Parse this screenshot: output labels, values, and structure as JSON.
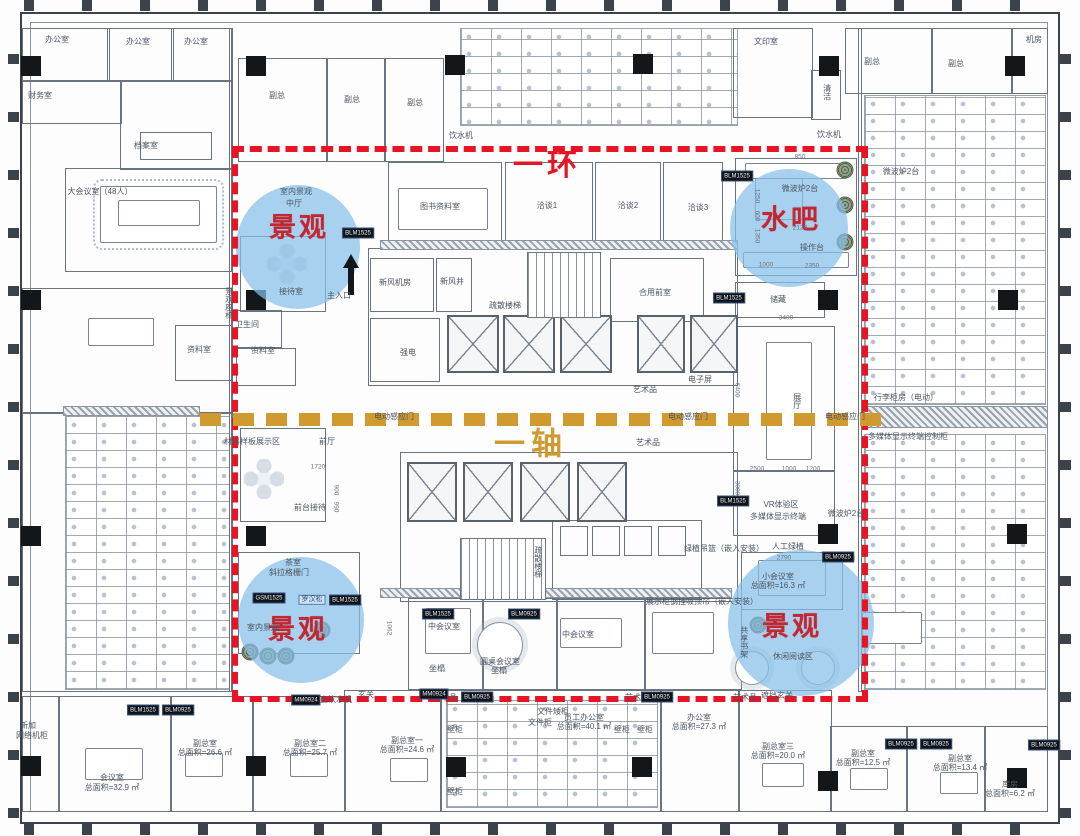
{
  "plan": {
    "ring_label": "一环",
    "axis_label": "一轴",
    "colors": {
      "ring_red": "#e81423",
      "axis_gold": "#d09a2e",
      "circle_blue": "#86bfe9",
      "annotation_red": "#c22832"
    }
  },
  "circles": [
    {
      "label": "景观",
      "cx": 298,
      "cy": 247,
      "r": 62,
      "lx": 299,
      "ly": 225
    },
    {
      "label": "水吧",
      "cx": 789,
      "cy": 228,
      "r": 59,
      "lx": 791,
      "ly": 217
    },
    {
      "label": "景观",
      "cx": 301,
      "cy": 620,
      "r": 63,
      "lx": 298,
      "ly": 627
    },
    {
      "label": "景观",
      "cx": 801,
      "cy": 623,
      "r": 73,
      "lx": 792,
      "ly": 624
    }
  ],
  "labels": [
    {
      "t": "办公室",
      "x": 57,
      "y": 40
    },
    {
      "t": "办公室",
      "x": 138,
      "y": 42
    },
    {
      "t": "办公室",
      "x": 196,
      "y": 42
    },
    {
      "t": "财务室",
      "x": 40,
      "y": 96
    },
    {
      "t": "档案室",
      "x": 146,
      "y": 146
    },
    {
      "t": "大会议室（48人）",
      "x": 100,
      "y": 192
    },
    {
      "t": "副总",
      "x": 277,
      "y": 96
    },
    {
      "t": "副总",
      "x": 352,
      "y": 100
    },
    {
      "t": "副总",
      "x": 415,
      "y": 103
    },
    {
      "t": "饮水机",
      "x": 461,
      "y": 136
    },
    {
      "t": "文印室",
      "x": 766,
      "y": 42
    },
    {
      "t": "清洁",
      "x": 827,
      "y": 92,
      "v": true
    },
    {
      "t": "副总",
      "x": 872,
      "y": 62
    },
    {
      "t": "副总",
      "x": 956,
      "y": 64
    },
    {
      "t": "机房",
      "x": 1034,
      "y": 40
    },
    {
      "t": "饮水机",
      "x": 829,
      "y": 135
    },
    {
      "t": "图书资料室",
      "x": 440,
      "y": 207
    },
    {
      "t": "洽谈1",
      "x": 547,
      "y": 206
    },
    {
      "t": "洽谈2",
      "x": 628,
      "y": 206
    },
    {
      "t": "洽谈3",
      "x": 698,
      "y": 208
    },
    {
      "t": "室内景观",
      "x": 296,
      "y": 192
    },
    {
      "t": "中厅",
      "x": 294,
      "y": 204
    },
    {
      "t": "景观座椅",
      "x": 229,
      "y": 303,
      "v": true
    },
    {
      "t": "接待室",
      "x": 291,
      "y": 292
    },
    {
      "t": "主入口",
      "x": 339,
      "y": 296
    },
    {
      "t": "卫生间",
      "x": 247,
      "y": 325
    },
    {
      "t": "资料室",
      "x": 199,
      "y": 350
    },
    {
      "t": "资料室",
      "x": 263,
      "y": 351
    },
    {
      "t": "新风机房",
      "x": 395,
      "y": 283
    },
    {
      "t": "新风井",
      "x": 452,
      "y": 282
    },
    {
      "t": "疏散楼梯",
      "x": 505,
      "y": 306
    },
    {
      "t": "合用前室",
      "x": 655,
      "y": 293
    },
    {
      "t": "强电",
      "x": 408,
      "y": 353
    },
    {
      "t": "艺术品",
      "x": 645,
      "y": 390
    },
    {
      "t": "电子屏",
      "x": 700,
      "y": 380
    },
    {
      "t": "艺术品",
      "x": 648,
      "y": 443
    },
    {
      "t": "微波炉2台",
      "x": 800,
      "y": 189
    },
    {
      "t": "微波炉2台",
      "x": 901,
      "y": 172
    },
    {
      "t": "操作台",
      "x": 812,
      "y": 248
    },
    {
      "t": "储藏",
      "x": 778,
      "y": 300
    },
    {
      "t": "材料样板展示区",
      "x": 252,
      "y": 442
    },
    {
      "t": "前厅",
      "x": 327,
      "y": 442
    },
    {
      "t": "前台接待",
      "x": 310,
      "y": 508
    },
    {
      "t": "电动感应门",
      "x": 394,
      "y": 417
    },
    {
      "t": "电动感应门",
      "x": 688,
      "y": 417
    },
    {
      "t": "电动感应门",
      "x": 845,
      "y": 417
    },
    {
      "t": "展厅",
      "x": 797,
      "y": 401,
      "v": true
    },
    {
      "t": "行李柜房（电动）",
      "x": 906,
      "y": 398
    },
    {
      "t": "多媒体显示终端控制柜",
      "x": 908,
      "y": 437
    },
    {
      "t": "VR体验区",
      "x": 781,
      "y": 505
    },
    {
      "t": "多媒体显示终端",
      "x": 778,
      "y": 517
    },
    {
      "t": "微波炉2台",
      "x": 846,
      "y": 514
    },
    {
      "t": "人工绿植",
      "x": 788,
      "y": 547
    },
    {
      "t": "绿植吊篮（嵌入安装）",
      "x": 724,
      "y": 549
    },
    {
      "t": "艺术品",
      "x": 843,
      "y": 557
    },
    {
      "t": "小会议室",
      "x": 778,
      "y": 577
    },
    {
      "t": "总面积=16.3 ㎡",
      "x": 778,
      "y": 586
    },
    {
      "t": "共享书架",
      "x": 744,
      "y": 642,
      "v": true
    },
    {
      "t": "休闲阅读区",
      "x": 793,
      "y": 657
    },
    {
      "t": "遮挡玄关",
      "x": 777,
      "y": 696
    },
    {
      "t": "茶室",
      "x": 293,
      "y": 563
    },
    {
      "t": "斜拉格栅门",
      "x": 289,
      "y": 573
    },
    {
      "t": "罗汉松",
      "x": 312,
      "y": 600,
      "c": "bluebox"
    },
    {
      "t": "室内景观",
      "x": 263,
      "y": 628
    },
    {
      "t": "中会议室",
      "x": 444,
      "y": 627
    },
    {
      "t": "圆桌会议室",
      "x": 500,
      "y": 662
    },
    {
      "t": "中会议室",
      "x": 578,
      "y": 635
    },
    {
      "t": "坐榻",
      "x": 437,
      "y": 669
    },
    {
      "t": "坐榻",
      "x": 499,
      "y": 671
    },
    {
      "t": "疏散楼梯",
      "x": 538,
      "y": 562,
      "v": true
    },
    {
      "t": "展示柜钢挂吸顶帘（嵌入安装）",
      "x": 702,
      "y": 602
    },
    {
      "t": "直饮水机",
      "x": 336,
      "y": 700
    },
    {
      "t": "玄关",
      "x": 366,
      "y": 695
    },
    {
      "t": "新加",
      "x": 28,
      "y": 726
    },
    {
      "t": "网络机柜",
      "x": 32,
      "y": 736
    },
    {
      "t": "会议室",
      "x": 112,
      "y": 778
    },
    {
      "t": "总面积=32.9 ㎡",
      "x": 112,
      "y": 788
    },
    {
      "t": "副总室",
      "x": 205,
      "y": 744
    },
    {
      "t": "总面积=26.6 ㎡",
      "x": 205,
      "y": 753
    },
    {
      "t": "副总室二",
      "x": 310,
      "y": 744
    },
    {
      "t": "总面积=25.7 ㎡",
      "x": 310,
      "y": 753
    },
    {
      "t": "副总室一",
      "x": 407,
      "y": 741
    },
    {
      "t": "总面积=24.6 ㎡",
      "x": 407,
      "y": 750
    },
    {
      "t": "文件矮柜",
      "x": 553,
      "y": 712
    },
    {
      "t": "文件柜",
      "x": 540,
      "y": 723
    },
    {
      "t": "员工办公室",
      "x": 584,
      "y": 718
    },
    {
      "t": "总面积=40.1 ㎡",
      "x": 584,
      "y": 727
    },
    {
      "t": "办公室",
      "x": 699,
      "y": 718
    },
    {
      "t": "总面积=27.3 ㎡",
      "x": 699,
      "y": 727
    },
    {
      "t": "壁柜",
      "x": 455,
      "y": 730
    },
    {
      "t": "壁柜",
      "x": 455,
      "y": 792
    },
    {
      "t": "壁柜",
      "x": 622,
      "y": 730
    },
    {
      "t": "壁柜",
      "x": 645,
      "y": 730
    },
    {
      "t": "艺术品",
      "x": 445,
      "y": 698
    },
    {
      "t": "艺术品",
      "x": 637,
      "y": 698
    },
    {
      "t": "艺术品",
      "x": 745,
      "y": 698
    },
    {
      "t": "副总室三",
      "x": 778,
      "y": 747
    },
    {
      "t": "总面积=20.0 ㎡",
      "x": 778,
      "y": 756
    },
    {
      "t": "副总室",
      "x": 863,
      "y": 754
    },
    {
      "t": "总面积=12.5 ㎡",
      "x": 863,
      "y": 763
    },
    {
      "t": "副总室",
      "x": 960,
      "y": 759
    },
    {
      "t": "总面积=13.4 ㎡",
      "x": 960,
      "y": 768
    },
    {
      "t": "库房",
      "x": 1010,
      "y": 785
    },
    {
      "t": "总面积=6.2 ㎡",
      "x": 1010,
      "y": 794
    }
  ],
  "dims": [
    {
      "t": "850",
      "x": 800,
      "y": 157
    },
    {
      "t": "1250",
      "x": 757,
      "y": 196,
      "v": true
    },
    {
      "t": "600",
      "x": 757,
      "y": 216,
      "v": true
    },
    {
      "t": "1350",
      "x": 757,
      "y": 236,
      "v": true
    },
    {
      "t": "2120",
      "x": 800,
      "y": 228
    },
    {
      "t": "1000",
      "x": 766,
      "y": 265
    },
    {
      "t": "2350",
      "x": 812,
      "y": 266
    },
    {
      "t": "3400",
      "x": 786,
      "y": 318
    },
    {
      "t": "6400",
      "x": 737,
      "y": 390,
      "v": true
    },
    {
      "t": "2500",
      "x": 757,
      "y": 469
    },
    {
      "t": "1000",
      "x": 789,
      "y": 469
    },
    {
      "t": "1200",
      "x": 813,
      "y": 469
    },
    {
      "t": "3000",
      "x": 737,
      "y": 488,
      "v": true
    },
    {
      "t": "2790",
      "x": 784,
      "y": 558
    },
    {
      "t": "1720",
      "x": 318,
      "y": 467
    },
    {
      "t": "900",
      "x": 336,
      "y": 490,
      "v": true
    },
    {
      "t": "990",
      "x": 336,
      "y": 507,
      "v": true
    },
    {
      "t": "1062",
      "x": 389,
      "y": 628,
      "v": true
    }
  ],
  "tags": [
    {
      "t": "BLM1525",
      "x": 358,
      "y": 233
    },
    {
      "t": "BLM1525",
      "x": 737,
      "y": 176
    },
    {
      "t": "BLM1525",
      "x": 729,
      "y": 298
    },
    {
      "t": "BLM1525",
      "x": 733,
      "y": 501
    },
    {
      "t": "BLM0925",
      "x": 838,
      "y": 557
    },
    {
      "t": "GSM1525",
      "x": 269,
      "y": 598
    },
    {
      "t": "BLM1525",
      "x": 345,
      "y": 600
    },
    {
      "t": "BLM1525",
      "x": 438,
      "y": 614
    },
    {
      "t": "BLM0925",
      "x": 524,
      "y": 614
    },
    {
      "t": "BLM1525",
      "x": 143,
      "y": 710
    },
    {
      "t": "BLM0925",
      "x": 178,
      "y": 710
    },
    {
      "t": "MM0924",
      "x": 306,
      "y": 700
    },
    {
      "t": "MM0924",
      "x": 434,
      "y": 694
    },
    {
      "t": "BLM0925",
      "x": 477,
      "y": 697
    },
    {
      "t": "BLM0925",
      "x": 657,
      "y": 697
    },
    {
      "t": "BLM0925",
      "x": 901,
      "y": 744
    },
    {
      "t": "BLM0925",
      "x": 936,
      "y": 744
    },
    {
      "t": "BLM0925",
      "x": 1044,
      "y": 745
    }
  ]
}
